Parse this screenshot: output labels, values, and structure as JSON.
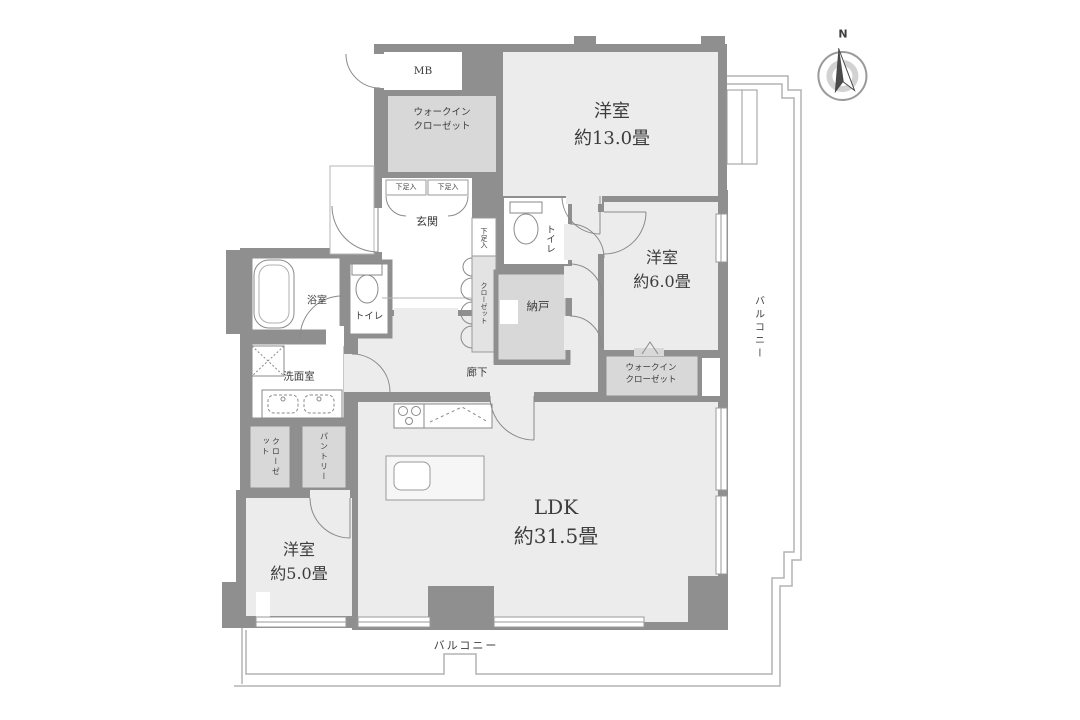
{
  "colors": {
    "wall": "#8f8f8f",
    "room_fill": "#ececec",
    "closet_fill": "#d8d8d8",
    "white_room_fill": "#ffffff",
    "balcony_line": "#b4b4b4",
    "text": "#3d3d3d"
  },
  "compass": {
    "north": "N"
  },
  "rooms": {
    "bedroom_north": {
      "name": "洋室",
      "size": "約13.0畳"
    },
    "bedroom_east": {
      "name": "洋室",
      "size": "約6.0畳"
    },
    "bedroom_west": {
      "name": "洋室",
      "size": "約5.0畳"
    },
    "ldk": {
      "name": "LDK",
      "size": "約31.5畳"
    },
    "walk_in_closet_north": {
      "line1": "ウォークイン",
      "line2": "クローゼット"
    },
    "walk_in_closet_east": {
      "line1": "ウォークイン",
      "line2": "クローゼット"
    },
    "entrance": {
      "name": "玄関"
    },
    "meter_box": {
      "name": "MB"
    },
    "storage_room": {
      "name": "納戸"
    },
    "toilet_north": {
      "name": "トイレ"
    },
    "toilet_west": {
      "name": "トイレ"
    },
    "bathroom": {
      "name": "浴室"
    },
    "washroom": {
      "name": "洗面室"
    },
    "corridor": {
      "name": "廊下"
    },
    "closet_entrance": {
      "name": "クローゼット"
    },
    "closet_west": {
      "name": "クローゼット"
    },
    "pantry": {
      "name": "パントリー"
    },
    "shoe_cabinet_left": {
      "name": "下足入"
    },
    "shoe_cabinet_right": {
      "name": "下足入"
    },
    "shoe_cabinet_side": {
      "name": "下足入"
    },
    "balcony_east": {
      "name": "バルコニー"
    },
    "balcony_south": {
      "name": "バルコニー"
    }
  }
}
